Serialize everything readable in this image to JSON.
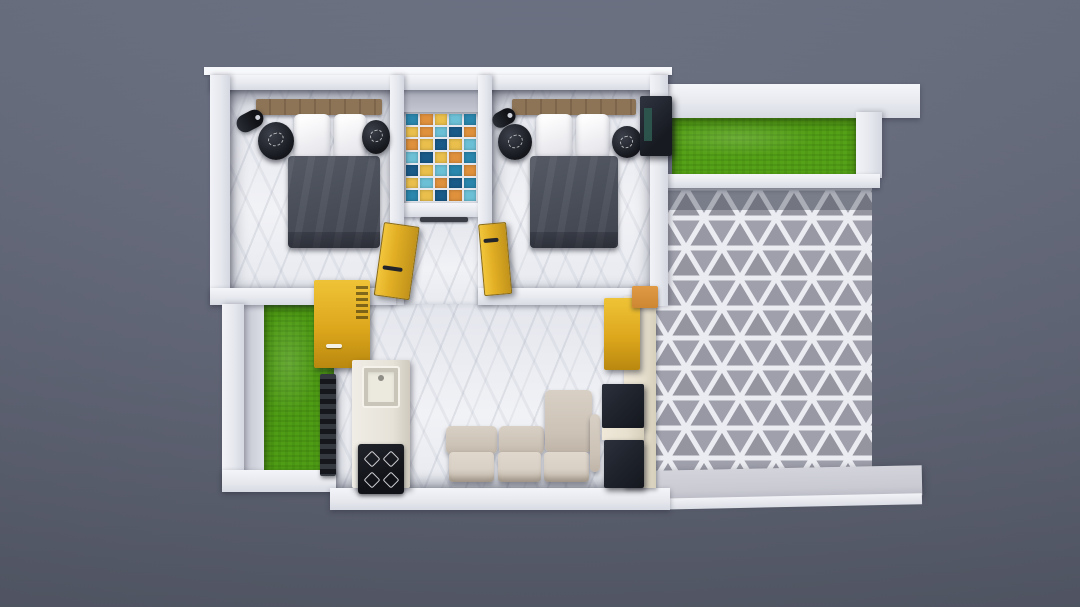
{
  "scene": {
    "type": "3d-floor-plan-render",
    "view": "top-down isometric-like",
    "description": "Photorealistic top-down render of a small apartment floor plan on a slate-gray backdrop: two bedrooms with dark bedding, a mosaic-tiled bathroom between them, central marble hall with kitchen counter and beige sofa, a green courtyard patch on the left, and a right-side patio with triangular gray tiles bordered by a grass strip",
    "rooms": [
      {
        "id": "bedroom-1",
        "position": "top-left"
      },
      {
        "id": "bathroom",
        "position": "top-center"
      },
      {
        "id": "bedroom-2",
        "position": "top-right-of-core"
      },
      {
        "id": "courtyard",
        "position": "mid-left"
      },
      {
        "id": "kitchen",
        "position": "center-left"
      },
      {
        "id": "living-room",
        "position": "bottom-center"
      },
      {
        "id": "patio",
        "position": "right"
      },
      {
        "id": "garden-strip",
        "position": "top-right"
      }
    ],
    "furniture": [
      "double-bed",
      "pillows",
      "wood-headboard",
      "round-side-table",
      "wall-lamp",
      "wardrobe",
      "yellow-door",
      "yellow-cabinet",
      "ladder-rack",
      "kitchen-counter",
      "sink",
      "gas-stove",
      "sofa-set",
      "chaise",
      "tv-units",
      "patio-door-sill",
      "platform-slab"
    ]
  },
  "palette": {
    "bg_top": "#6a7082",
    "bg_mid": "#5f6476",
    "bg_bottom": "#545968",
    "wall": "#eef0f4",
    "marble": "#ecedf2",
    "grass": "#55a117",
    "courtyard_grass": "#4f9c15",
    "door_yellow": "#e2af24",
    "cabinet_yellow": "#dda71c",
    "duvet": "#4a4f5a",
    "wood": "#8d7456",
    "sofa": "#ccc2b6",
    "sofa_seat": "#d9d0c6",
    "dark_unit": "#20242d",
    "cream": "#e7e0cf",
    "orange_sill": "#cd8733",
    "patio_tile": "#9fa0ac",
    "grout": "#eaecf1",
    "platform": "#c9cad2"
  },
  "mosaic": {
    "rows": 7,
    "cols": 5,
    "legend": {
      "db": "#1a5a88",
      "tl": "#2a86ac",
      "lb": "#6cc0d6",
      "or": "#df913c",
      "yl": "#eabf4c"
    },
    "grid": [
      [
        "tl",
        "or",
        "yl",
        "lb",
        "tl"
      ],
      [
        "yl",
        "or",
        "lb",
        "db",
        "or"
      ],
      [
        "or",
        "yl",
        "db",
        "yl",
        "lb"
      ],
      [
        "lb",
        "db",
        "yl",
        "or",
        "tl"
      ],
      [
        "db",
        "yl",
        "lb",
        "tl",
        "or"
      ],
      [
        "yl",
        "lb",
        "or",
        "db",
        "tl"
      ],
      [
        "tl",
        "yl",
        "db",
        "or",
        "lb"
      ]
    ]
  }
}
